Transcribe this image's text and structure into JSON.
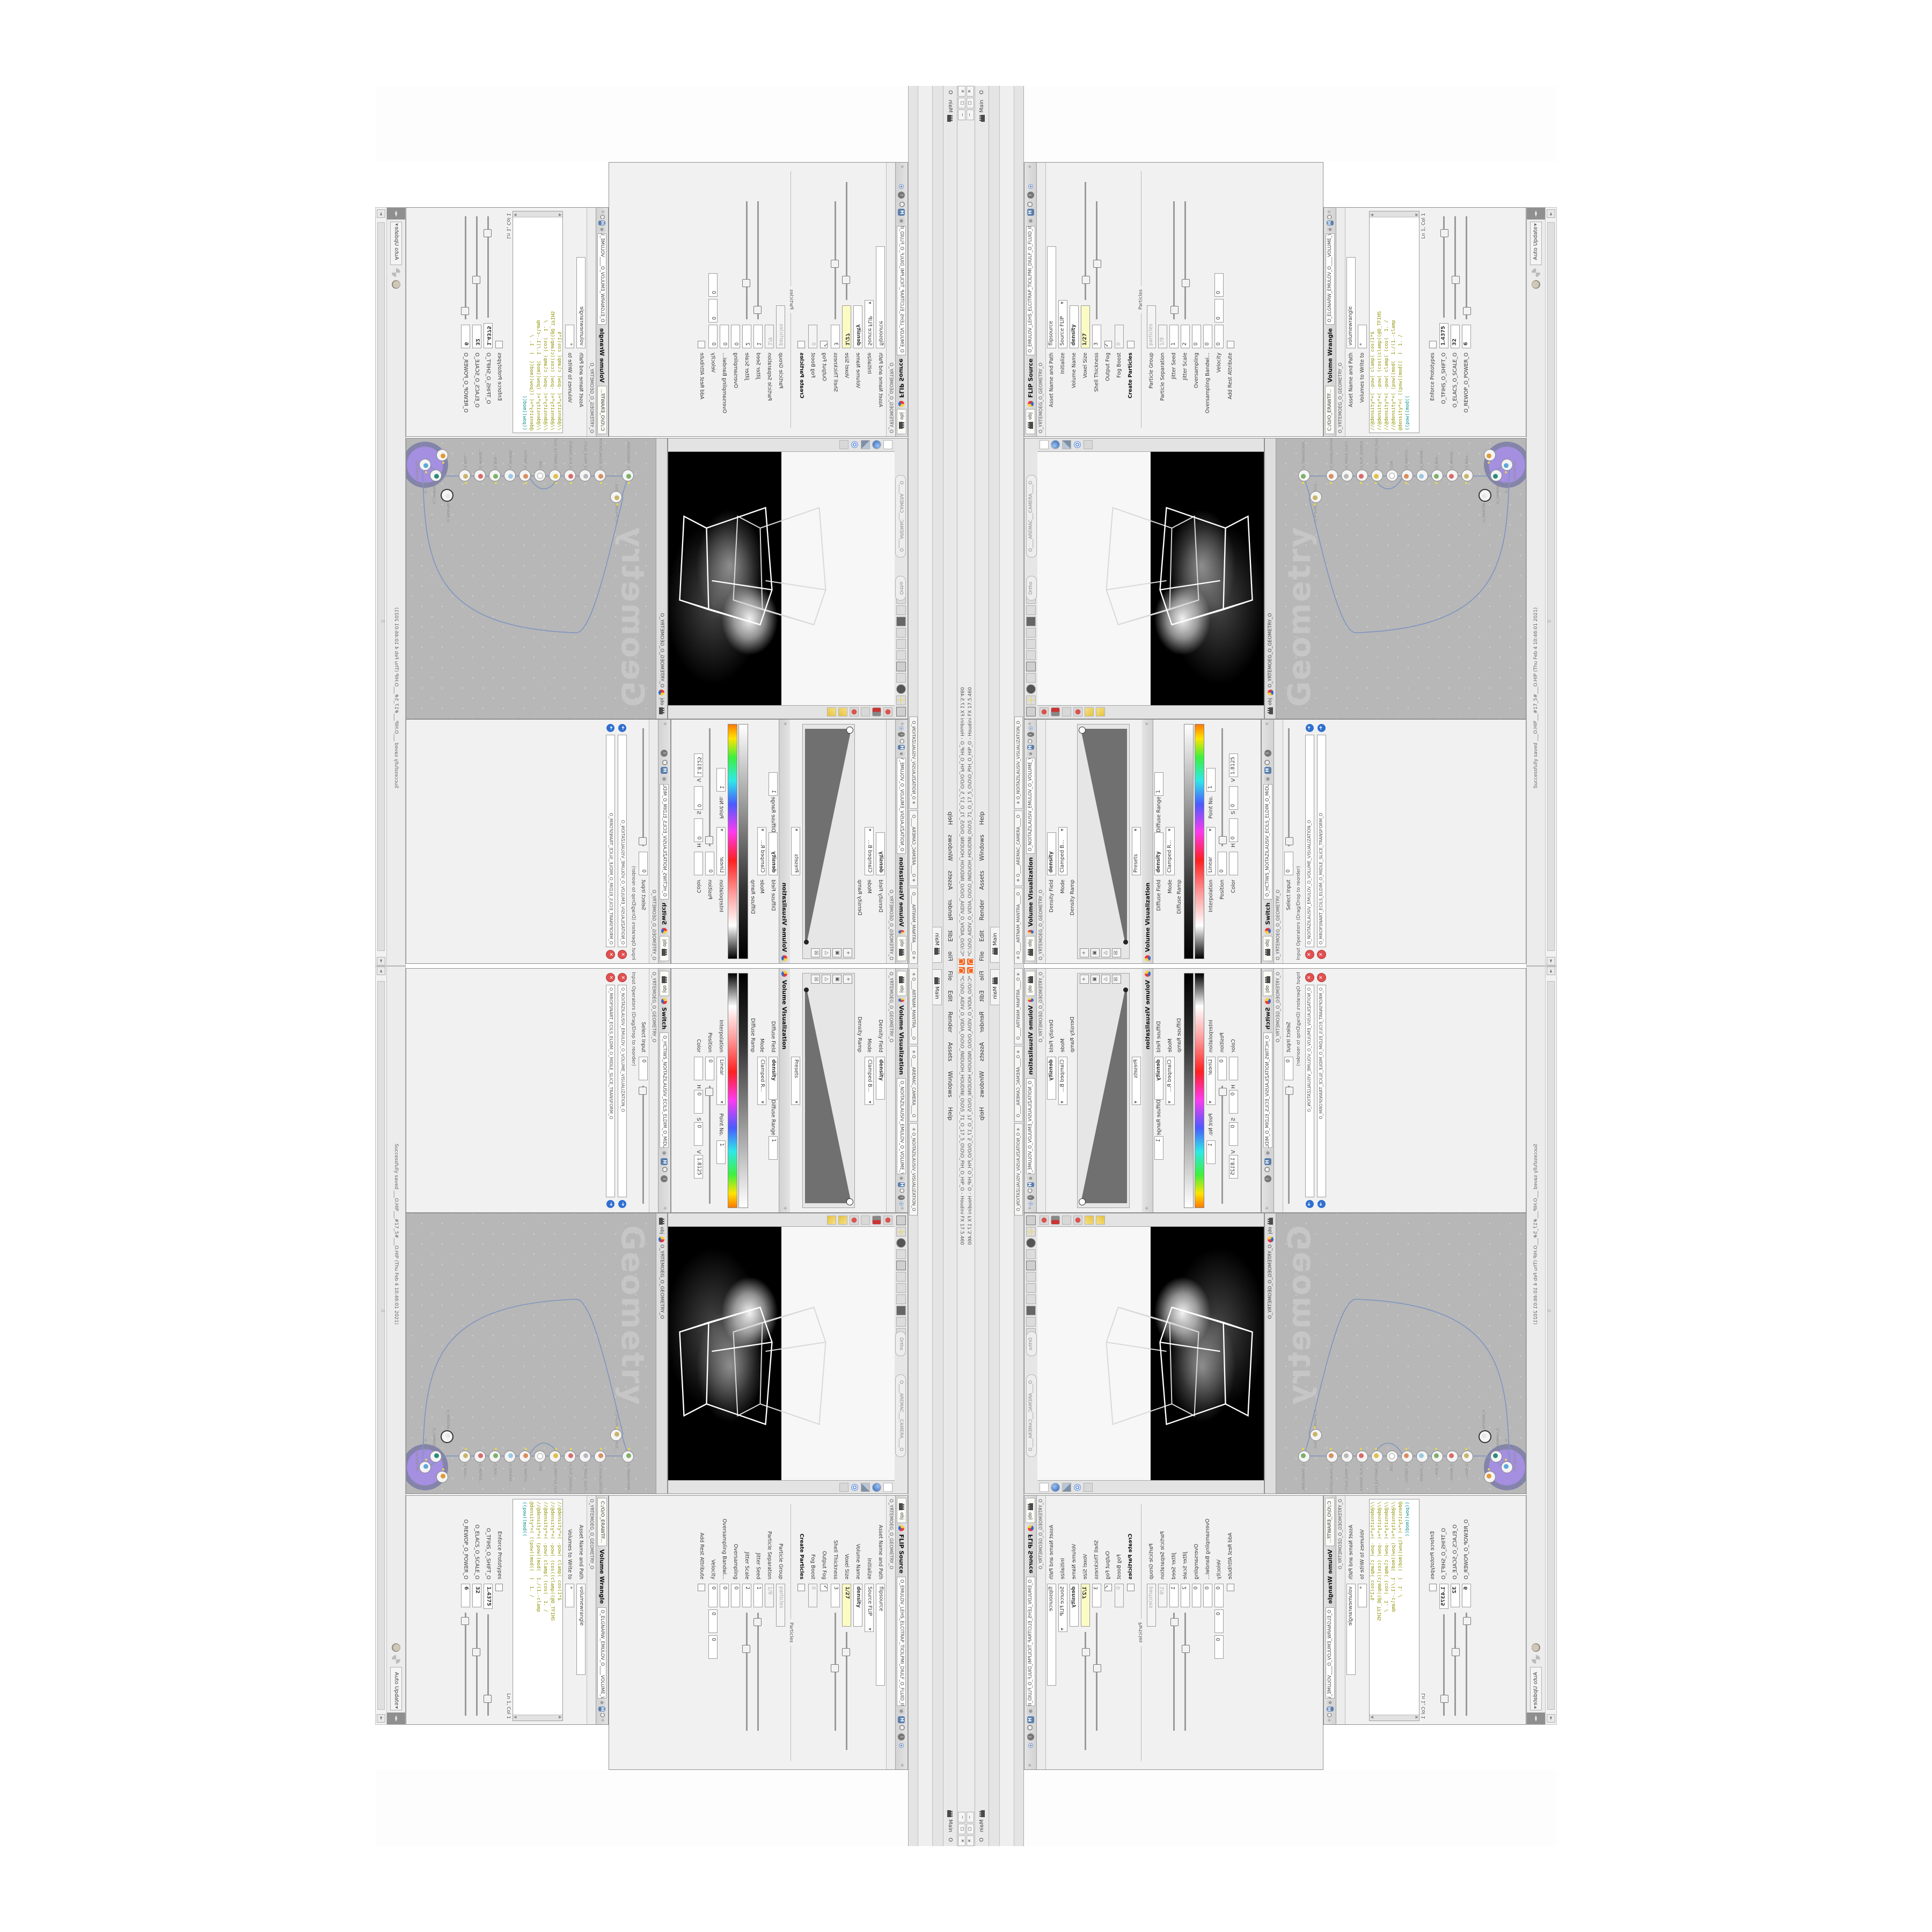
{
  "window": {
    "title": "*C:\\O\\O_AIDIV_O_VIDIA_O\\O\\O_INIDUOH_HOUDINI_O\\O\\5_71_O_17_5_O\\O\\O_PIH_O_HIP_O  -  Houdini FX 17.5.460",
    "minimize": "−",
    "maximize": "▢",
    "close": "✕"
  },
  "menu": {
    "items": [
      "File",
      "Edit",
      "Render",
      "Assets",
      "Windows",
      "Help"
    ],
    "right_label": "Main",
    "right_extra": "O"
  },
  "shelf": {
    "main_tab": "Main",
    "pane_tabs": [
      "✳ O____ARTNAM_MANTRA____O",
      "✳ O____AREMAC_CAMERA____O",
      "✳ O_NOITAZILAUSIV_VISUALIZATION_O"
    ]
  },
  "status": {
    "auto_update": "Auto Update",
    "message": "Successfully saved ___O.HIP___#17_5#___O.HIP  (Thu Feb 4 10:46:01 2021)",
    "arrows": "◄►"
  },
  "flip": {
    "title": "FLIP Source",
    "path": "O_EMULOV_LEHS_ELCITRAP_TICILPMI_DIULF_O_FLUID_IMPLICIT_PARTICLE_SHELL_VOLUME_O",
    "subpath": "O_YRTEMOEG_O_GEOMETRY_O",
    "tab": "obj",
    "asset_label": "Asset Name and Path",
    "asset_value": "flipsource",
    "initialize_label": "Initialize",
    "initialize_value": "Source FLIP",
    "volname_label": "Volume Name",
    "volname_value": "density",
    "voxel_label": "Voxel Size",
    "voxel_value": "1/27",
    "shell_label": "Shell Thickness",
    "shell_value": "3",
    "outputfog_label": "Output Fog",
    "fogboost_label": "Fog Boost",
    "fogboost_value": "0",
    "createparticles_label": "Create Particles",
    "particles_section": "Particles",
    "pgroup_label": "Particle Group",
    "pgroup_value": "particles",
    "psep_label": "Particle Separation",
    "psep_value": "1/9",
    "jseed_label": "Jitter Seed",
    "jseed_value": "1",
    "jscale_label": "Jitter Scale",
    "jscale_value": "2",
    "oversampling_label": "Oversampling",
    "oversampling_value": "0",
    "oversamplingbw_label": "Oversampling Bandwi...",
    "oversamplingbw_value": "0",
    "velocity_label": "Velocity",
    "velocity_values": [
      "0",
      "0",
      "0"
    ],
    "addrest_label": "Add Rest Attribute"
  },
  "wrangle": {
    "title": "Volume Wrangle",
    "path": "O_ELGNARW_EMULOV_O____VOLUME_WRANGLE___O",
    "subpath": "O_YRTEMOEG_O_GEOMETRY_O",
    "tab": "C:/O/O_ERAWTF...",
    "asset_label": "Asset Name and Path",
    "asset_value": "volumewrangle",
    "volumes_label": "Volumes to Write to",
    "volumes_value": "*",
    "code": [
      "//@density*=( -pow( clamp( cos(1*$",
      "//@density*=( -pow( (cos((clamp((@O_TFIHS",
      "//@density*=( -pow( clamp( (cos(  1. /",
      "//@density*=( (pow((mod(  1./(1.-clamp",
      "@density*=( ((pow((mod((  )  1. /"
    ],
    "code_kw": "((pow((mod((",
    "cursor": "Ln 1, Col 1",
    "enforce_label": "Enforce Prototypes",
    "spare": [
      {
        "label": "O_TFIHS_O_SHIFT_O",
        "value": "1.4375"
      },
      {
        "label": "O_ELACS_O_SCALE_O",
        "value": "32"
      },
      {
        "label": "O_REWOP_O_POWER_O",
        "value": "6"
      }
    ]
  },
  "viewport": {
    "ortho_pill": "Ortho",
    "camera_pill": "O____AREMAC___CAMERA____O",
    "tab": "obj",
    "path": "O_YRTEMOEG_O_GEOMETRY_O"
  },
  "network": {
    "watermark": "Geometry",
    "tab": "obj",
    "path": "O_YRTEMOEG_O_GEOMETRY_O",
    "nodes": [
      "O_TRANSFORM...",
      "O_VOLUME_WRANGLE...",
      "O_VISUALIZATION...",
      "O_MIDLE_SLICE...",
      "O_FLIP_SOURCE...",
      "O_PARTICLE_FLUID...",
      "CGB",
      "O_SWITCH...",
      "O_SPHERE...",
      "O_BOX...",
      "O_MERGE...",
      "O_NULL...",
      "O_MANTRA...",
      "O_GEOMETRY...",
      "O_CAMERA...",
      "O_OUT..."
    ]
  },
  "volviz": {
    "title": "Volume Visualization",
    "title2": "Volume Visualization",
    "path": "O_NOITAZILAUSIV_EMULOV_O_VOLUME_VISUALIZATION_O",
    "subpath": "O_YRTEMOEG_O_GEOMETRY_O",
    "tab": "obj",
    "densfield_label": "Density Field",
    "densfield_value": "density",
    "mode_label": "Mode",
    "mode_value": "Clamped B...",
    "densramp_label": "Density Ramp",
    "presets_label": "Presets",
    "difffield_label": "Diffuse Field",
    "difffield_value": "density",
    "mode2_label": "Mode",
    "mode2_value": "Clamped R...",
    "diffrange_label": "Diffuse Range",
    "diffrange_value": "1",
    "difframp_label": "Diffuse Ramp",
    "interp_label": "Interpolation",
    "interp_value": "Linear",
    "pointno_label": "Point No.",
    "pointno_value": "1",
    "pos_label": "Position",
    "pos_value": "0",
    "color_label": "Color",
    "h_label": "H",
    "h_value": "0",
    "s_label": "S",
    "s_value": "0",
    "v_label": "V",
    "v_value": "1.8125"
  },
  "switch": {
    "title": "Switch",
    "path": "O_HCTIWS_NOITAZILAUSIV_ECILS_ELDIM_O_MIDLE_SLICE_VISUALIZATION_SWITCH_O",
    "subpath": "O_YRTEMOEG_O_GEOMETRY_O",
    "tab": "obj",
    "select_label": "Select Input",
    "select_value": "0",
    "ops_label": "Input Operators (Drag/Drop to reorder)",
    "items": [
      "O_NOITAZILAUSIV_EMULOV_O_VOLUME_VISUALIZATION_O",
      "O_MROFSNART_ECILS_ELDIM_O_MIDLE_SLICE_TRANSFORM_O"
    ]
  }
}
